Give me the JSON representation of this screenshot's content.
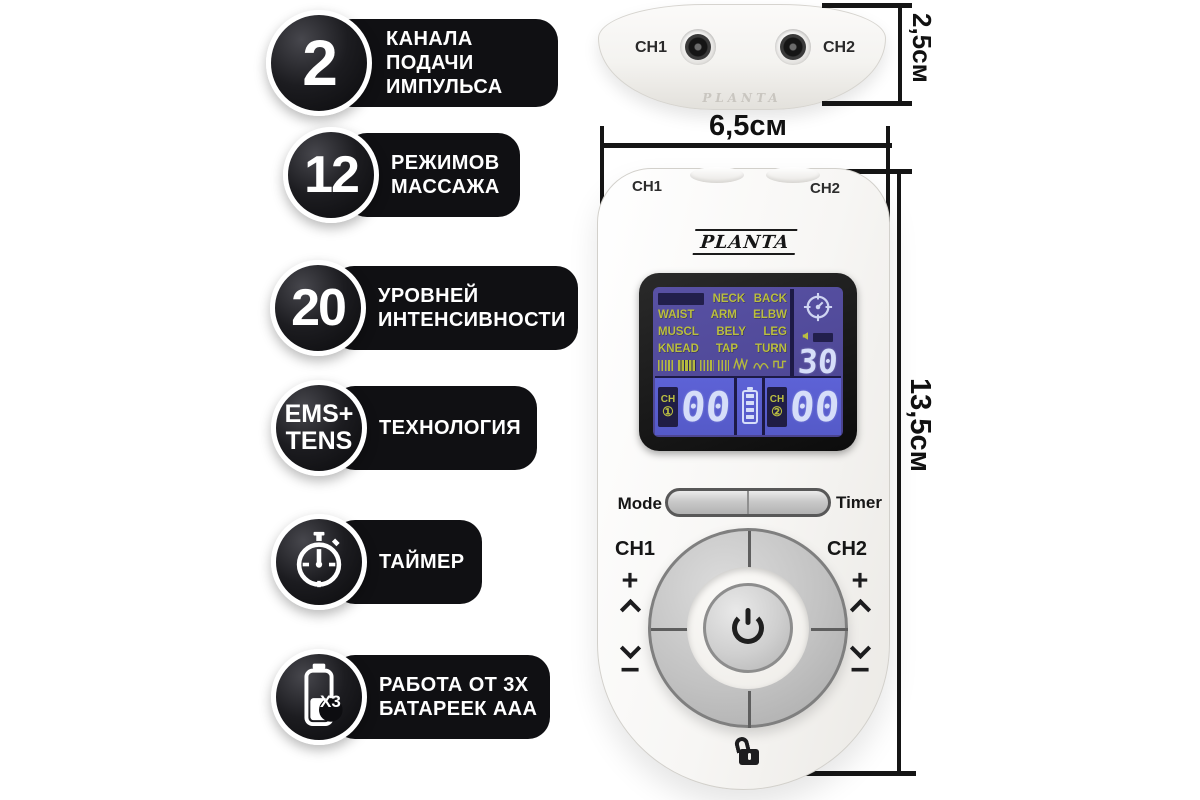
{
  "features": [
    {
      "badge_value": "2",
      "label_lines": [
        "КАНАЛА ПОДАЧИ",
        "ИМПУЛЬСА"
      ]
    },
    {
      "badge_value": "12",
      "label_lines": [
        "РЕЖИМОВ",
        "МАССАЖА"
      ]
    },
    {
      "badge_value": "20",
      "label_lines": [
        "УРОВНЕЙ",
        "ИНТЕНСИВНОСТИ"
      ]
    },
    {
      "badge_line1": "EMS+",
      "badge_line2": "TENS",
      "label_lines": [
        "ТЕХНОЛОГИЯ"
      ]
    },
    {
      "badge_icon": "stopwatch",
      "label_lines": [
        "ТАЙМЕР"
      ]
    },
    {
      "badge_icon": "battery",
      "badge_value": "X3",
      "label_lines": [
        "РАБОТА ОТ 3X",
        "БАТАРЕЕК AAA"
      ]
    }
  ],
  "top_view": {
    "ch1_label": "CH1",
    "ch2_label": "CH2"
  },
  "dimensions": {
    "depth": "2,5см",
    "width": "6,5см",
    "height": "13,5см"
  },
  "device": {
    "brand": "PLANTA",
    "ch1_port_label": "CH1",
    "ch2_port_label": "CH2",
    "lcd": {
      "mode_grid": [
        [
          "NECK",
          "BACK"
        ],
        [
          "WAIST",
          "ARM",
          "ELBW"
        ],
        [
          "MUSCL",
          "BELY",
          "LEG"
        ],
        [
          "KNEAD",
          "TAP",
          "TURN"
        ]
      ],
      "timer_value": "30",
      "ch1_label": "CH",
      "ch1_badge": "①",
      "ch1_value": "00",
      "ch2_label": "CH",
      "ch2_badge": "②",
      "ch2_value": "00"
    },
    "controls": {
      "mode_label": "Mode",
      "timer_label": "Timer",
      "ch1_label": "CH1",
      "ch2_label": "CH2",
      "plus": "+",
      "minus": "−"
    }
  },
  "colors": {
    "badge_black": "#101013",
    "lcd_top_bg": "#4e4794",
    "lcd_bottom_bg": "#5a5fd1",
    "lcd_text": "#babe40",
    "lcd_digits": "#d6def9",
    "lcd_chip": "#221f4c"
  }
}
